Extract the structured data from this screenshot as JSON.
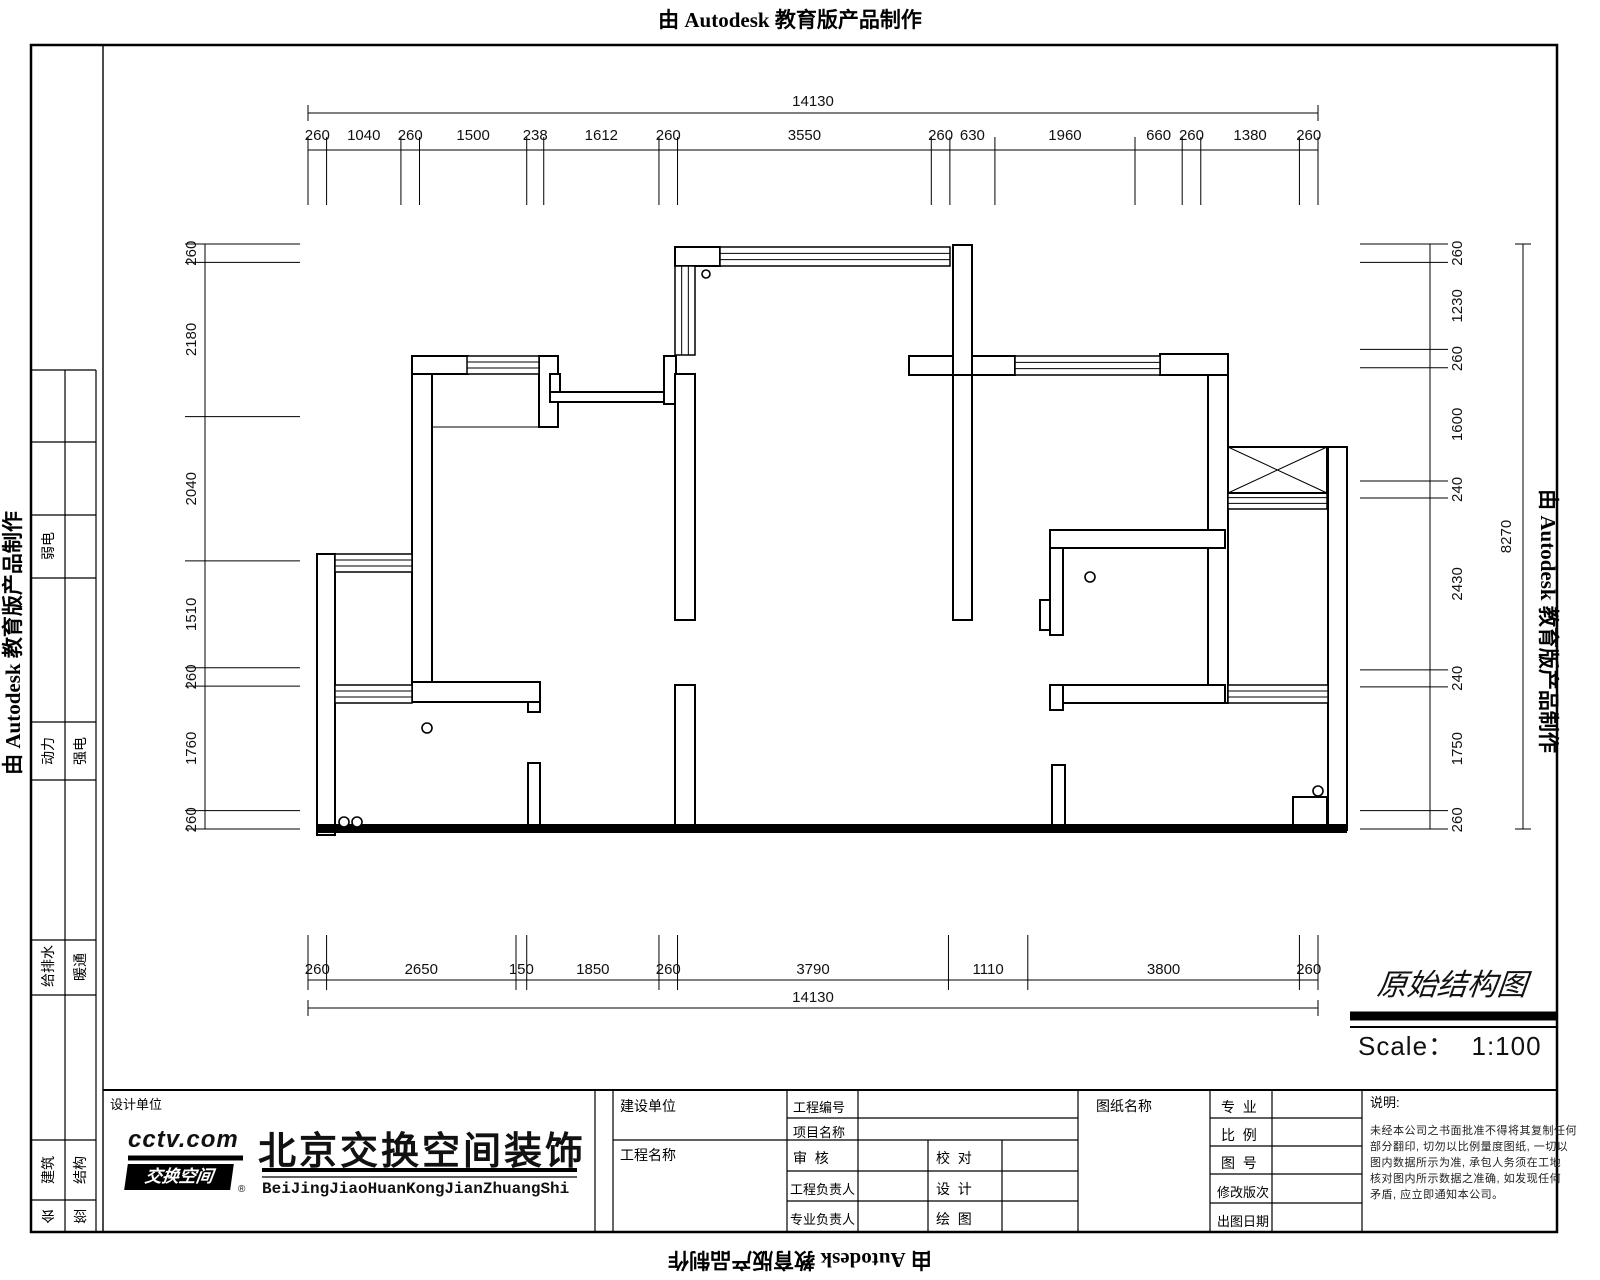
{
  "stamp": {
    "text": "由 Autodesk 教育版产品制作"
  },
  "title_area": {
    "name": "原始结构图",
    "scale": "Scale：  1:100"
  },
  "sidebar": {
    "cells": [
      {
        "x": 48,
        "y": 546,
        "label": "弱电",
        "rot": -90
      },
      {
        "x": 80,
        "y": 751,
        "label": "强电",
        "rot": -90
      },
      {
        "x": 48,
        "y": 751,
        "label": "动力",
        "rot": -90
      },
      {
        "x": 48,
        "y": 967,
        "label": "给排水",
        "rot": -90
      },
      {
        "x": 80,
        "y": 967,
        "label": "暖通",
        "rot": -90
      },
      {
        "x": 48,
        "y": 1170,
        "label": "建筑",
        "rot": -90
      },
      {
        "x": 80,
        "y": 1170,
        "label": "结构",
        "rot": -90
      },
      {
        "x": 48,
        "y": 1216,
        "label": "会",
        "rot": 180
      },
      {
        "x": 80,
        "y": 1216,
        "label": "签",
        "rot": 180
      }
    ]
  },
  "company": {
    "section_label": "设计单位",
    "logo_line1": "cctv.com",
    "logo_line2": "交换空间",
    "logo_reg": "®",
    "name_cn": "北京交换空间装饰",
    "name_en": "BeiJingJiaoHuanKongJianZhuangShi"
  },
  "titleblock": {
    "owner_label": "建设单位",
    "project_name_label": "工程名称",
    "project_no_label": "工程编号",
    "item_name_label": "项目名称",
    "review_label": "审  核",
    "check_label": "校  对",
    "project_lead_label": "工程负责人",
    "design_label": "设  计",
    "discipline_lead_label": "专业负责人",
    "draft_label": "绘  图",
    "sheet_name_label": "图纸名称",
    "discipline_label": "专  业",
    "scale_label": "比  例",
    "sheet_no_label": "图  号",
    "revision_label": "修改版次",
    "issue_date_label": "出图日期",
    "notes_label": "说明:",
    "notes_lines": [
      "未经本公司之书面批准不得将其复制任何",
      "部分翻印, 切勿以比例量度图纸, 一切以",
      "图内数据所示为准, 承包人务须在工地",
      "核对图内所示数据之准确, 如发现任何",
      "矛盾, 应立即通知本公司。"
    ]
  },
  "dims": {
    "top": {
      "orient": "h",
      "origin": 308,
      "length": 1010,
      "total": 14130,
      "line": 150,
      "text": 140,
      "ext": [
        137,
        205
      ],
      "segs": [
        260,
        1040,
        260,
        1500,
        238,
        1612,
        260,
        3550,
        260,
        630,
        1960,
        660,
        260,
        1380,
        260
      ],
      "overall": {
        "line": 113,
        "text": 106
      }
    },
    "bottom": {
      "orient": "h",
      "origin": 308,
      "length": 1010,
      "total": 14130,
      "line": 980,
      "text": 974,
      "ext": [
        935,
        990
      ],
      "segs": [
        260,
        2650,
        150,
        1850,
        260,
        3790,
        1110,
        3800,
        260
      ],
      "overall": {
        "line": 1008,
        "text": 1002
      }
    },
    "left": {
      "orient": "v",
      "origin": 244,
      "length": 585,
      "total": 8270,
      "line": 205,
      "text": 196,
      "ext": [
        185,
        300
      ],
      "segs": [
        260,
        2180,
        2040,
        1510,
        260,
        1760,
        260
      ]
    },
    "right": {
      "orient": "v",
      "origin": 244,
      "length": 585,
      "total": 8270,
      "line": 1430,
      "text": 1462,
      "ext": [
        1360,
        1448
      ],
      "segs": [
        260,
        1230,
        260,
        1600,
        240,
        2430,
        240,
        1750,
        260
      ],
      "overall": {
        "line": 1523,
        "text": 1511
      }
    }
  },
  "plan": {
    "walls": [
      [
        675,
        247,
        45,
        19
      ],
      [
        412,
        356,
        56,
        18
      ],
      [
        539,
        356,
        19,
        71
      ],
      [
        412,
        374,
        20,
        308
      ],
      [
        550,
        374,
        10,
        26
      ],
      [
        550,
        392,
        124,
        10
      ],
      [
        664,
        356,
        12,
        48
      ],
      [
        909,
        356,
        106,
        19
      ],
      [
        953,
        245,
        19,
        131
      ],
      [
        953,
        375,
        19,
        245
      ],
      [
        1160,
        354,
        68,
        21
      ],
      [
        1208,
        375,
        20,
        328
      ],
      [
        1050,
        530,
        175,
        18
      ],
      [
        1050,
        548,
        13,
        87
      ],
      [
        1040,
        600,
        10,
        30
      ],
      [
        1063,
        685,
        162,
        18
      ],
      [
        1050,
        685,
        13,
        25
      ],
      [
        412,
        682,
        128,
        20
      ],
      [
        528,
        702,
        12,
        10
      ],
      [
        317,
        554,
        18,
        281
      ],
      [
        675,
        374,
        20,
        246
      ],
      [
        675,
        685,
        20,
        141
      ],
      [
        528,
        763,
        12,
        63
      ],
      [
        1052,
        765,
        13,
        61
      ],
      [
        1293,
        797,
        34,
        31
      ],
      [
        1328,
        447,
        19,
        383
      ]
    ],
    "solid": [
      [
        317,
        824,
        1030,
        9
      ]
    ],
    "windows": [
      [
        720,
        247,
        230,
        19,
        "h"
      ],
      [
        675,
        266,
        20,
        89,
        "v"
      ],
      [
        467,
        356,
        72,
        18,
        "h"
      ],
      [
        1015,
        356,
        145,
        19,
        "h"
      ],
      [
        1228,
        492,
        99,
        17,
        "h"
      ],
      [
        335,
        554,
        77,
        18,
        "h"
      ],
      [
        335,
        685,
        77,
        18,
        "h"
      ],
      [
        1228,
        685,
        100,
        18,
        "h"
      ]
    ],
    "xboxes": [
      [
        1228,
        447,
        99,
        46
      ]
    ],
    "circles": [
      [
        706,
        274,
        4
      ],
      [
        427,
        728,
        5
      ],
      [
        344,
        822,
        5
      ],
      [
        357,
        822,
        5
      ],
      [
        1090,
        577,
        5
      ],
      [
        1318,
        791,
        5
      ]
    ],
    "thin": [
      [
        432,
        427,
        539,
        427
      ]
    ]
  },
  "sheet": {
    "border": [
      31,
      45,
      1526,
      1187
    ],
    "lines": [
      [
        103,
        45,
        103,
        1232,
        1.4
      ],
      [
        65,
        370,
        65,
        1232,
        1.2
      ],
      [
        96,
        370,
        96,
        1232,
        1.2
      ],
      [
        31,
        370,
        96,
        370,
        1.2
      ],
      [
        31,
        442,
        96,
        442,
        1.2
      ],
      [
        31,
        515,
        96,
        515,
        1.2
      ],
      [
        31,
        578,
        96,
        578,
        1.2
      ],
      [
        31,
        722,
        96,
        722,
        1.2
      ],
      [
        31,
        780,
        96,
        780,
        1.2
      ],
      [
        31,
        940,
        96,
        940,
        1.2
      ],
      [
        31,
        995,
        96,
        995,
        1.2
      ],
      [
        31,
        1140,
        96,
        1140,
        1.2
      ],
      [
        31,
        1200,
        96,
        1200,
        1.2
      ],
      [
        103,
        1090,
        1557,
        1090,
        2
      ],
      [
        595,
        1090,
        595,
        1232,
        1.2
      ],
      [
        613,
        1090,
        613,
        1232,
        1.2
      ],
      [
        787,
        1090,
        787,
        1232,
        1.2
      ],
      [
        858,
        1090,
        858,
        1232,
        1.2
      ],
      [
        1078,
        1090,
        1078,
        1232,
        1.2
      ],
      [
        1210,
        1090,
        1210,
        1232,
        1.2
      ],
      [
        1272,
        1090,
        1272,
        1232,
        1.2
      ],
      [
        1362,
        1090,
        1362,
        1232,
        1.2
      ],
      [
        928,
        1140,
        928,
        1232,
        1.2
      ],
      [
        1002,
        1140,
        1002,
        1232,
        1.2
      ],
      [
        787,
        1118,
        1078,
        1118,
        1.2
      ],
      [
        613,
        1140,
        1078,
        1140,
        1.2
      ],
      [
        787,
        1171,
        1078,
        1171,
        1.2
      ],
      [
        787,
        1201,
        1078,
        1201,
        1.2
      ],
      [
        1210,
        1118,
        1362,
        1118,
        1.2
      ],
      [
        1210,
        1146,
        1362,
        1146,
        1.2
      ],
      [
        1210,
        1174,
        1362,
        1174,
        1.2
      ],
      [
        1210,
        1203,
        1362,
        1203,
        1.2
      ],
      [
        1350,
        1016,
        1556,
        1016,
        9
      ],
      [
        1350,
        1027,
        1556,
        1027,
        2
      ],
      [
        128,
        1158,
        243,
        1158,
        5
      ],
      [
        262,
        1170,
        577,
        1170,
        4
      ],
      [
        262,
        1177,
        577,
        1177,
        1.2
      ]
    ]
  }
}
